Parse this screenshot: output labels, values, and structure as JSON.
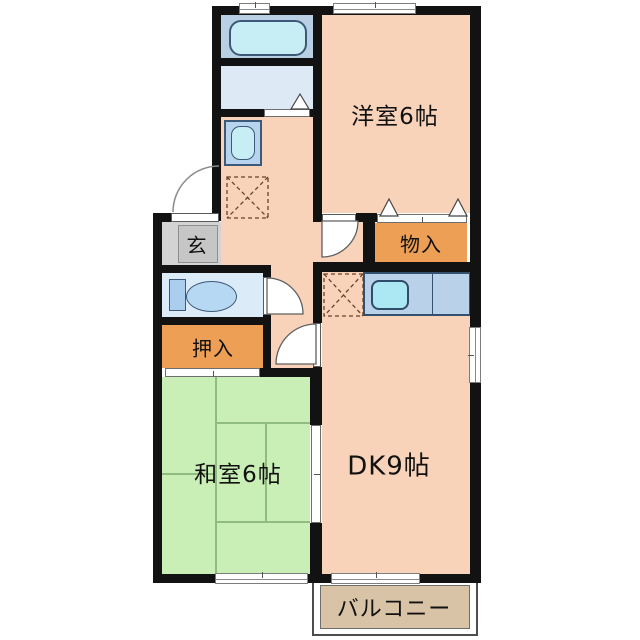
{
  "rooms": {
    "western_room": {
      "label": "洋室6帖"
    },
    "storage": {
      "label": "物入"
    },
    "entrance": {
      "label": "玄"
    },
    "closet": {
      "label": "押入"
    },
    "japanese_room": {
      "label": "和室6帖"
    },
    "dining_kitchen": {
      "label": "DK9帖"
    },
    "balcony": {
      "label": "バルコニー"
    }
  },
  "fixtures": {
    "bathtub": "bathtub-icon",
    "washing_machine": "washing-machine-icon",
    "toilet": "toilet-icon",
    "kitchen_sink": "kitchen-sink-icon",
    "refrigerator_space": "dashed-x-square",
    "laundry_space": "dashed-x-square"
  },
  "colors": {
    "wall": "#121212",
    "room_salmon": "#f8d3ba",
    "tatami_green": "#c9efb6",
    "closet_orange": "#ec9f55",
    "balcony_tan": "#d9c3a6",
    "entrance_gray": "#d3d3d3",
    "bath_blue": "#b9cfe3",
    "washroom_blue": "#dde9f4",
    "toilet_blue": "#dcebf8",
    "counter_blue": "#b9d2ea",
    "sink_cyan": "#ace8f4"
  }
}
